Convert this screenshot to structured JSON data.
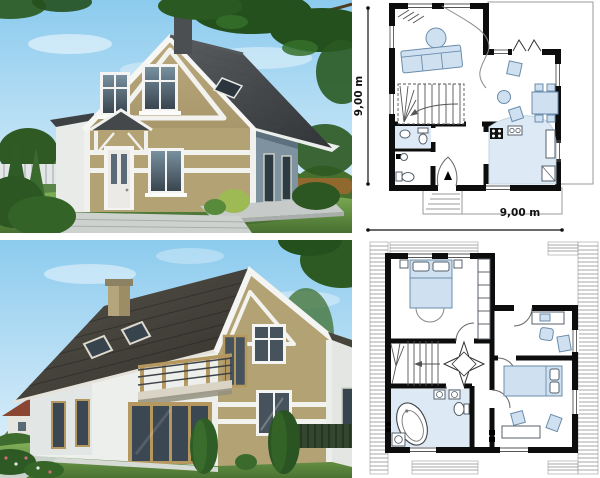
{
  "ground_floor_plan": {
    "dimension_left": "9,00 m",
    "dimension_bottom": "9,00 m"
  },
  "palette": {
    "sky": "#9ed3f0",
    "grass": "#659544",
    "roof_front": "#45484a",
    "roof_rear": "#46443a",
    "wall_tan": "#b3a274",
    "wall_white": "#eef0ee",
    "wood": "#b5985f",
    "glass": "#41505c",
    "plan_wall": "#0d0d0d",
    "furniture_blue": "#cfe1f1",
    "floor_blue": "#ddeaf6",
    "hatch_gray": "#8a8a8a",
    "terrace_gray": "#c6cbc9"
  }
}
